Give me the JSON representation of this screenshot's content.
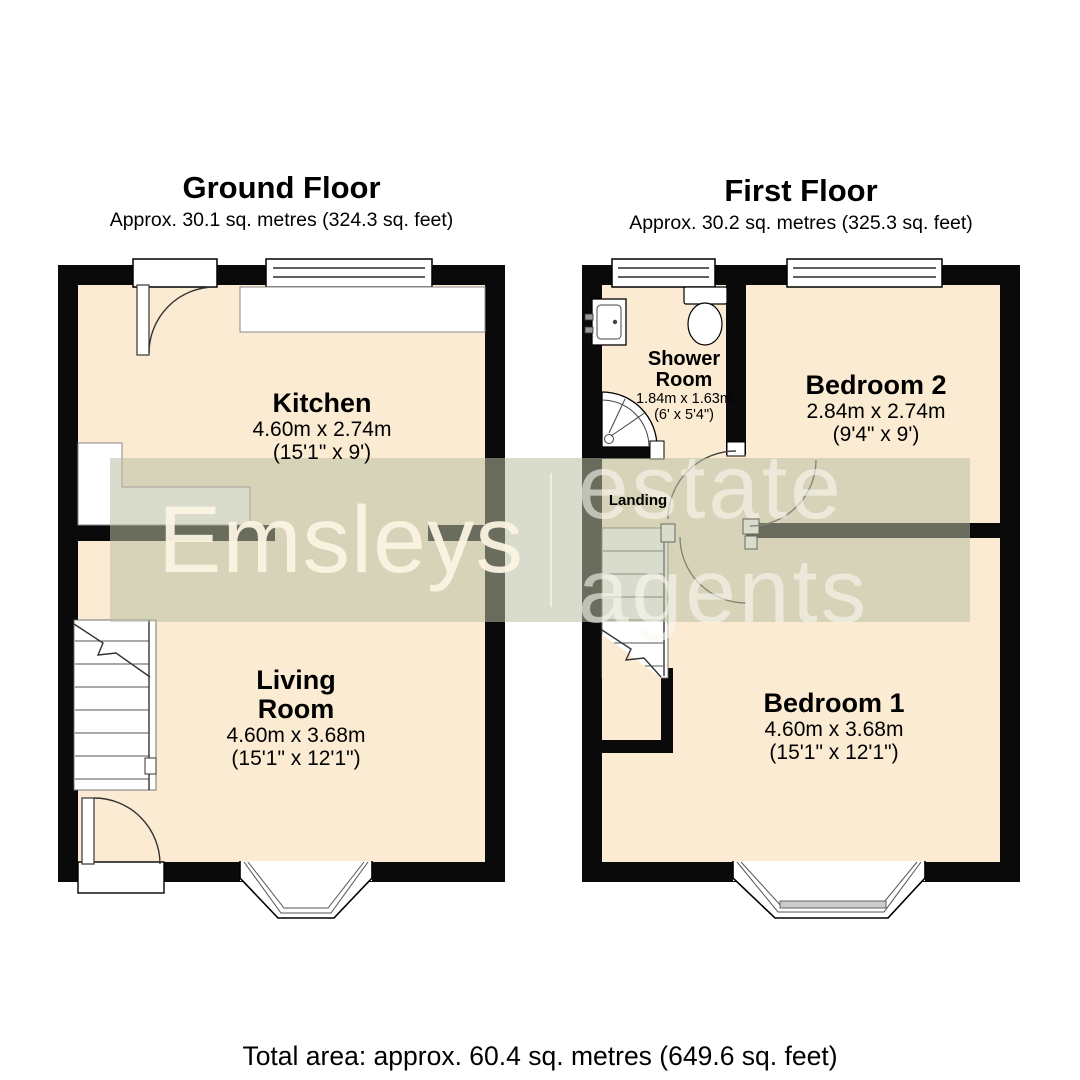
{
  "colors": {
    "floor_fill": "#faebd2",
    "wall": "#0a0a0a",
    "watermark_band": "#b9bfa4",
    "watermark_text": "#f9f1dd"
  },
  "ground_floor": {
    "title": "Ground Floor",
    "subtitle": "Approx. 30.1 sq. metres (324.3 sq. feet)",
    "kitchen": {
      "name": "Kitchen",
      "metric": "4.60m x 2.74m",
      "imperial": "(15'1\" x 9')"
    },
    "living_room": {
      "name": "Living Room",
      "metric": "4.60m x 3.68m",
      "imperial": "(15'1\" x 12'1\")"
    }
  },
  "first_floor": {
    "title": "First Floor",
    "subtitle": "Approx. 30.2 sq. metres (325.3 sq. feet)",
    "shower_room": {
      "name": "Shower Room",
      "metric": "1.84m x 1.63m",
      "imperial": "(6' x 5'4\")"
    },
    "bedroom_2": {
      "name": "Bedroom 2",
      "metric": "2.84m x 2.74m",
      "imperial": "(9'4\" x 9')"
    },
    "bedroom_1": {
      "name": "Bedroom 1",
      "metric": "4.60m x 3.68m",
      "imperial": "(15'1\" x 12'1\")"
    },
    "landing_label": "Landing"
  },
  "watermark": {
    "brand": "Emsleys",
    "suffix": "estate agents"
  },
  "footer": {
    "total_area": "Total area: approx. 60.4 sq. metres (649.6 sq. feet)"
  }
}
